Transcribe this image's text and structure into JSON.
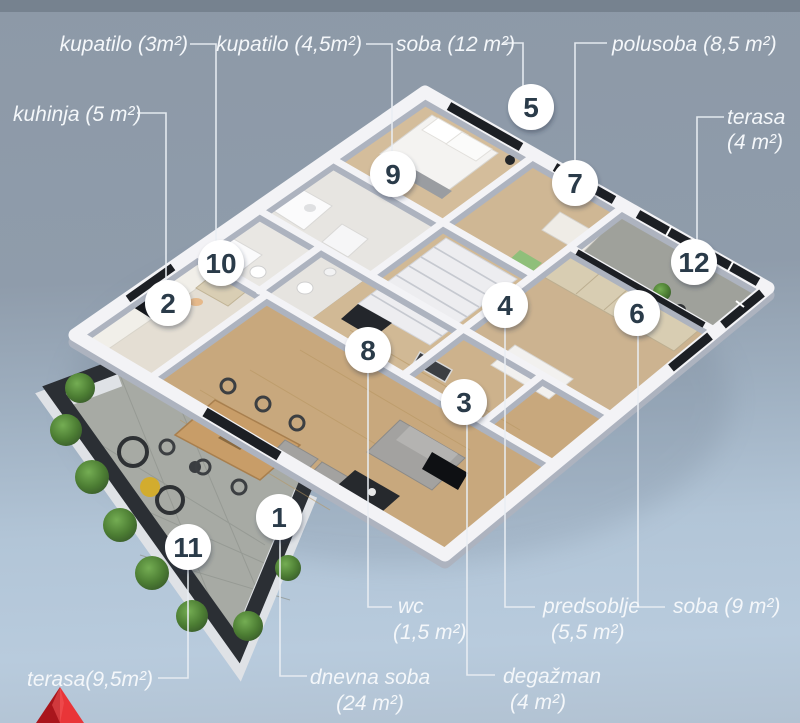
{
  "background": {
    "top_strip_color": "#76828f",
    "sky_top": "#8d99a7",
    "sky_bottom": "#b8cbdd"
  },
  "logo": {
    "shape": "red-pyramid",
    "color_left": "#a9151c",
    "color_right": "#e93538"
  },
  "plan": {
    "markers": [
      {
        "n": "1",
        "room": "dnevna soba"
      },
      {
        "n": "2",
        "room": "kuhinja"
      },
      {
        "n": "3",
        "room": "degažman"
      },
      {
        "n": "4",
        "room": "predsoblje"
      },
      {
        "n": "5",
        "room": "soba 12 m²"
      },
      {
        "n": "6",
        "room": "soba 9 m²"
      },
      {
        "n": "7",
        "room": "polusoba"
      },
      {
        "n": "8",
        "room": "wc"
      },
      {
        "n": "9",
        "room": "kupatilo 4,5 m²"
      },
      {
        "n": "10",
        "room": "kupatilo 3 m²"
      },
      {
        "n": "11",
        "room": "terasa 9,5 m²"
      },
      {
        "n": "12",
        "room": "terasa 4 m²"
      }
    ],
    "labels": {
      "kupatilo3": "kupatilo (3m²)",
      "kupatilo45": "kupatilo (4,5m²)",
      "soba12": "soba (12 m²)",
      "polusoba": "polusoba (8,5 m²)",
      "terasa4_1": "terasa",
      "terasa4_2": "(4 m²)",
      "kuhinja": "kuhinja (5 m²)",
      "terasa95": "terasa(9,5m²)",
      "dnevna1": "dnevna soba",
      "dnevna2": "(24 m²)",
      "wc1": "wc",
      "wc2": "(1,5 m²)",
      "predsoblje1": "predsoblje",
      "predsoblje2": "(5,5 m²)",
      "degazman1": "degažman",
      "degazman2": "(4 m²)",
      "soba9": "soba (9 m²)"
    }
  }
}
